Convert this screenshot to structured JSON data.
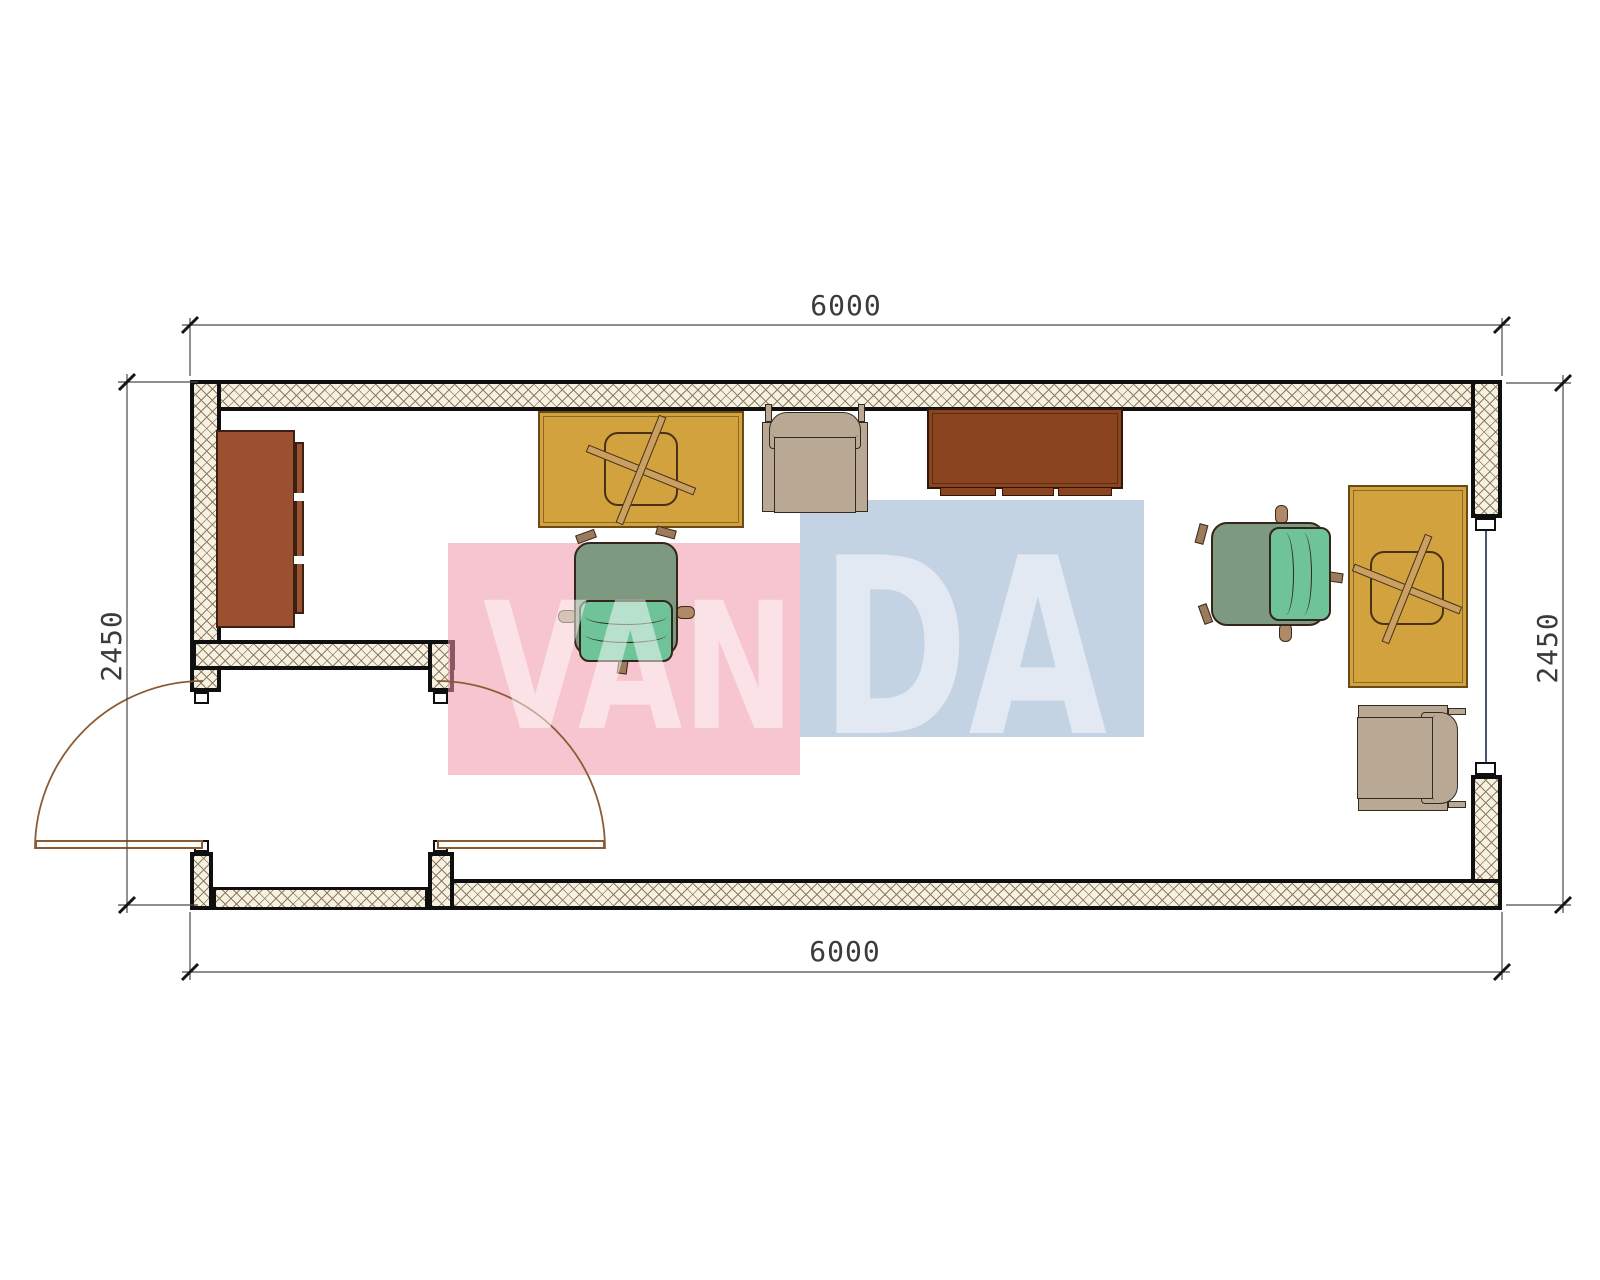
{
  "plan": {
    "title": "container-office-floor-plan",
    "dimensions": {
      "width_top": "6000",
      "width_bottom": "6000",
      "height_left": "2450",
      "height_right": "2450"
    },
    "watermark": {
      "text": "VANDA",
      "left_part": "VAN",
      "right_part": "DA",
      "pink_color": "#f7c8d1",
      "blue_color": "#ccd9e8"
    },
    "walls": {
      "fill": "#f6f1e2",
      "hatch_line": "#8d7c5d",
      "border": "#101010"
    },
    "openings": [
      {
        "name": "double-entry-door",
        "wall": "bottom-left"
      },
      {
        "name": "window",
        "wall": "right"
      }
    ],
    "furniture": [
      {
        "name": "cabinet",
        "color": "#9b512f"
      },
      {
        "name": "desk-with-chair-cross",
        "color": "#d2a23e"
      },
      {
        "name": "armchair-top",
        "color": "#b8a894"
      },
      {
        "name": "sideboard-table",
        "color": "#8a4520"
      },
      {
        "name": "office-chair-middle",
        "seat": "#6fc398",
        "back": "#7d997f"
      },
      {
        "name": "office-chair-right",
        "seat": "#6fc398",
        "back": "#7d997f"
      },
      {
        "name": "desk-with-chair-cross-right",
        "color": "#d2a23e"
      },
      {
        "name": "armchair-right",
        "color": "#b8a894"
      }
    ]
  }
}
